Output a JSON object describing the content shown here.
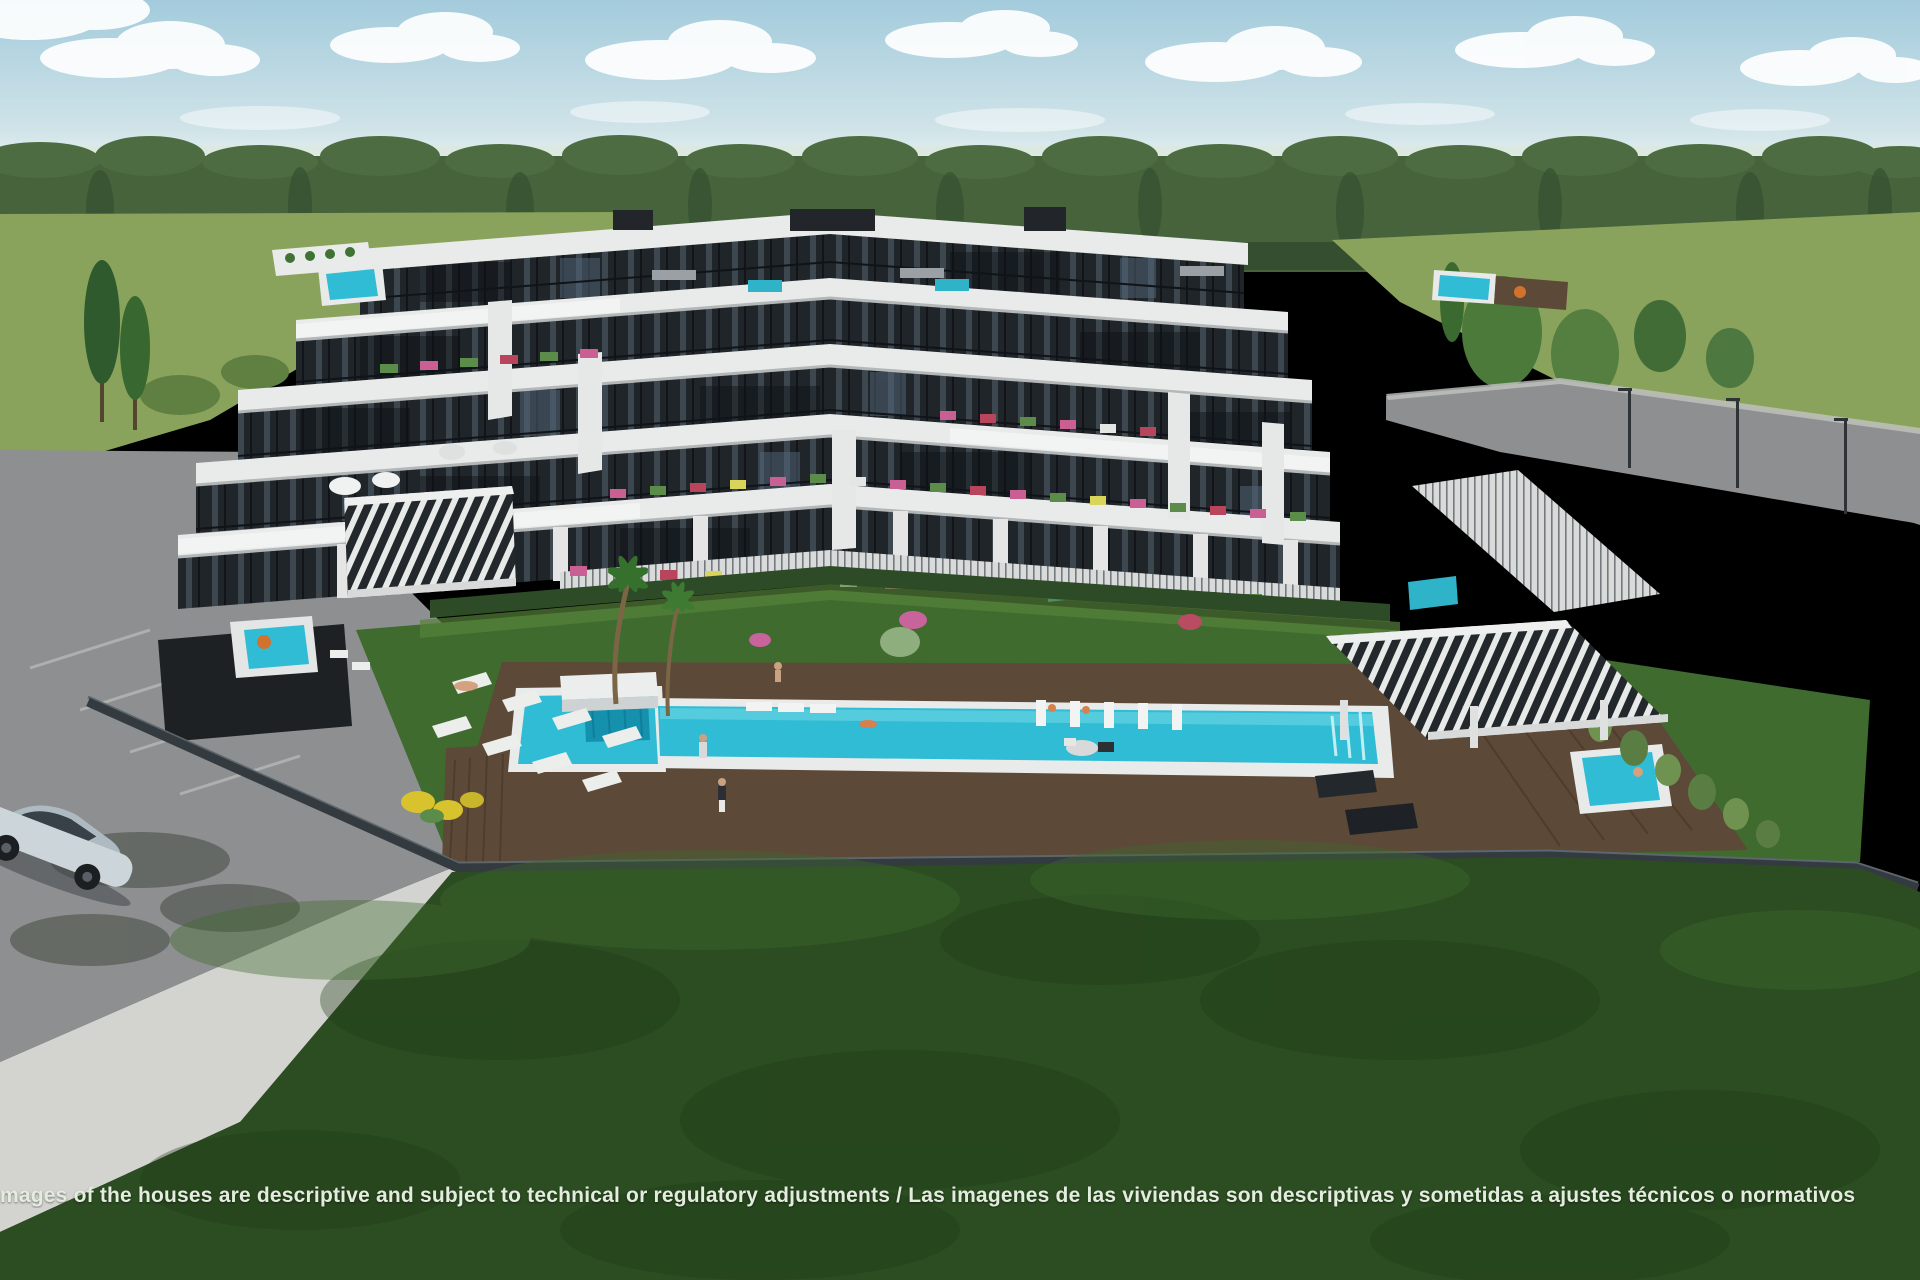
{
  "disclaimer": {
    "text": "mages of the houses are descriptive and subject to technical or regulatory adjustments / Las imagenes de las viviendas son descriptivas y sometidas a ajustes técnicos o normativos"
  },
  "palette": {
    "sky_top": "#a3cbdc",
    "sky_horizon": "#e9f2f2",
    "cloud": "#ffffff",
    "forest": "#46633c",
    "field": "#8aa35c",
    "garden_lawn": "#3f6b2e",
    "foreground_lawn": "#2b4d21",
    "pool": "#2fbcd4",
    "pool_spa": "#1691ad",
    "deck": "#5d4937",
    "building_white": "#e9eaea",
    "glass_dark": "#20252a",
    "road": "#8e8f90",
    "sidewalk": "#d3d4d0",
    "fence": "#343b40",
    "car": "#ccd5da",
    "furniture_accent": "#2fb3c9",
    "flower_pink": "#c95f92",
    "flower_yellow": "#d8c32e",
    "text": "#e4ecdf"
  }
}
